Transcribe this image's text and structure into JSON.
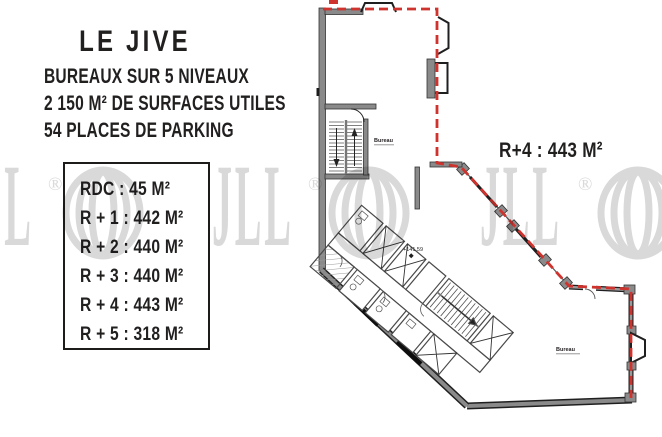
{
  "colors": {
    "accent_red": "#ce332e",
    "wall_gray": "#8a8a8a",
    "ink": "#221f1f",
    "watermark_gray": "#d9d9d9"
  },
  "info_panel": {
    "title": "LE JIVE",
    "line1": "BUREAUX SUR 5 NIVEAUX",
    "line2": "2 150 M² DE SURFACES UTILES",
    "line3": "54 PLACES DE PARKING"
  },
  "area_table": {
    "rows": [
      "RDC : 45 M²",
      "R + 1 : 442 M²",
      "R + 2 : 440 M²",
      "R + 3 : 440 M²",
      "R + 4 : 443 M²",
      "R + 5 : 318 M²"
    ]
  },
  "floor_plan": {
    "floor_label": "R+4 : 443 M²",
    "room_label_top": "Bureau",
    "room_label_bottom": "Bureau",
    "level_marker": "+141.59"
  },
  "watermark": {
    "wordmark": "JLL",
    "registered": "®",
    "emblem_icon": "jll-sphere-icon"
  }
}
